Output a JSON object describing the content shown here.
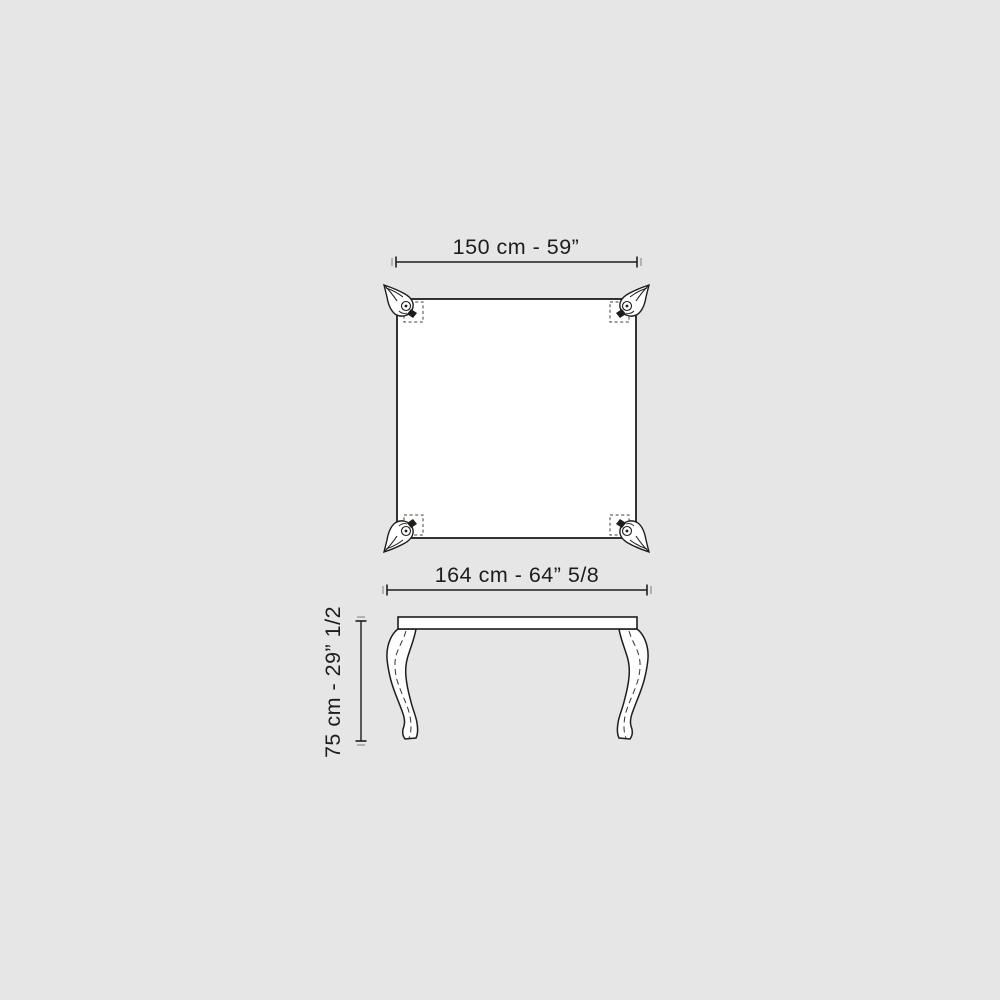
{
  "colors": {
    "bg": "#e6e6e6",
    "ink": "#1d1d1b",
    "paper": "#ffffff",
    "tickLight": "#9b9b9b"
  },
  "top_view": {
    "width_label": "150 cm - 59”"
  },
  "front_view": {
    "width_label": "164 cm - 64” 5/8",
    "height_label": "75 cm - 29” 1/2"
  }
}
